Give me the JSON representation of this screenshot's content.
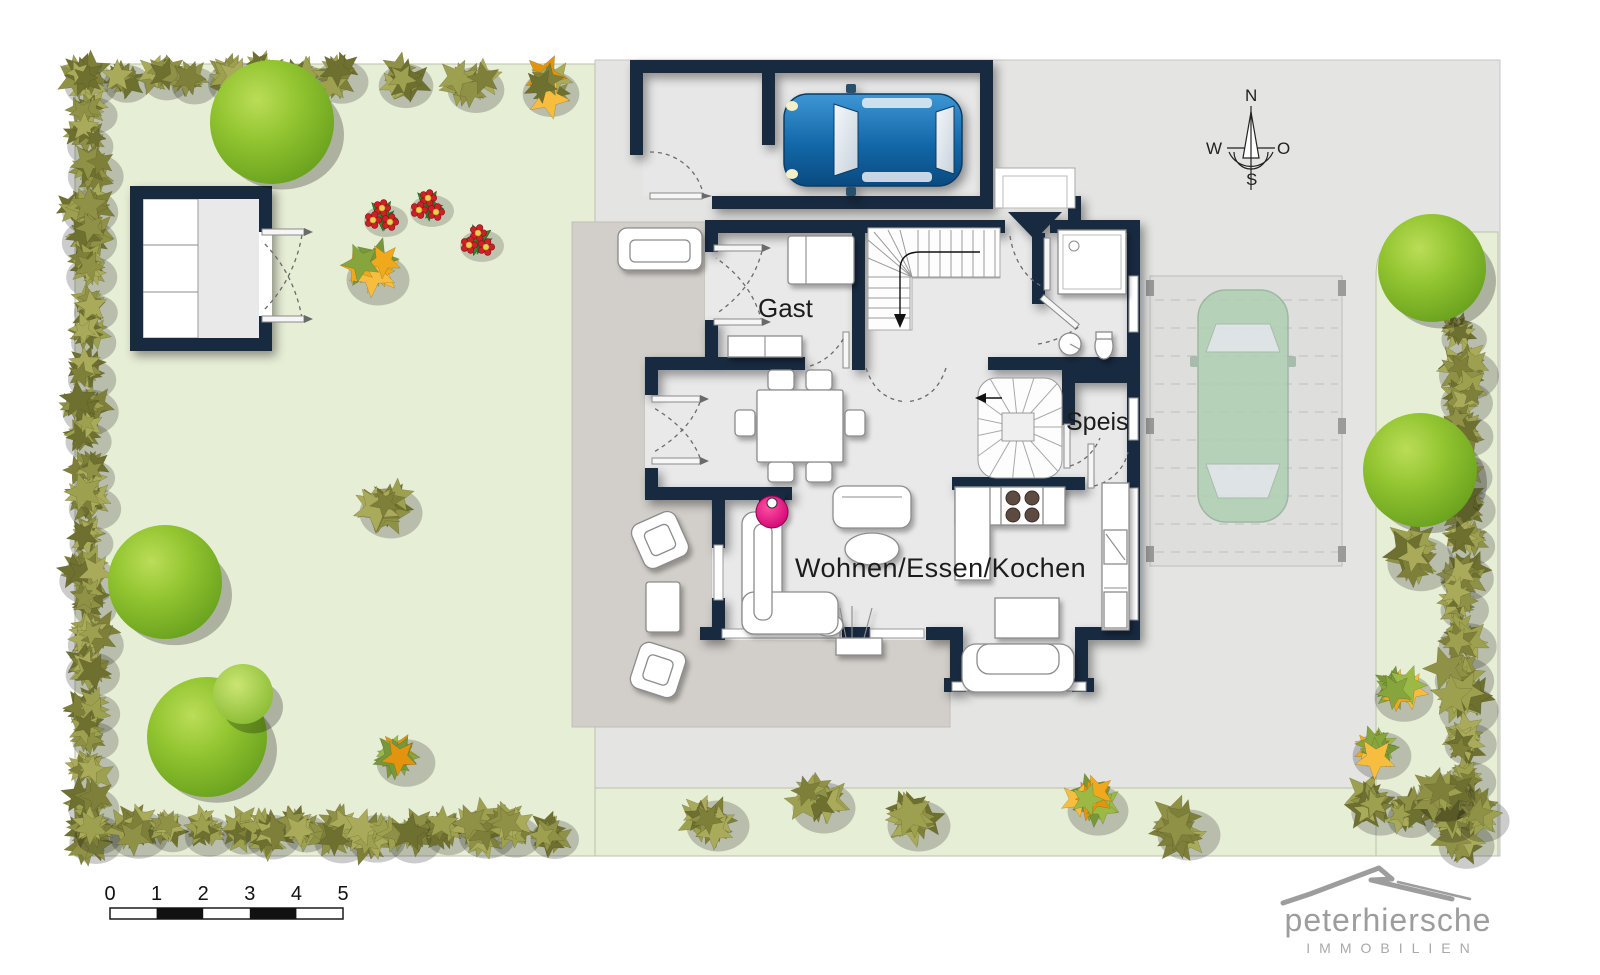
{
  "site_plan": {
    "rooms": {
      "gast": "Gast",
      "speis": "Speis",
      "living": "Wohnen/Essen/Kochen"
    },
    "compass": {
      "north": "N",
      "east": "O",
      "south": "S",
      "west": "W"
    },
    "scale_bar": {
      "ticks": [
        "0",
        "1",
        "2",
        "3",
        "4",
        "5"
      ]
    },
    "logo": {
      "brand": "peterhiersche",
      "subtitle": "IMMOBILIEN"
    },
    "colors": {
      "wall": "#182a40",
      "garden": "#e7eed6",
      "paved": "#e4e4e3",
      "terrace": "#d2cec9",
      "hedge": "#8f9146",
      "tree": "#8fc32e",
      "flower_orange": "#f0a81c",
      "car_blue": "#1471b8",
      "car_green": "#abd0b0",
      "stove_pink": "#e5007d",
      "logo_gray": "#9d9d9d"
    }
  }
}
